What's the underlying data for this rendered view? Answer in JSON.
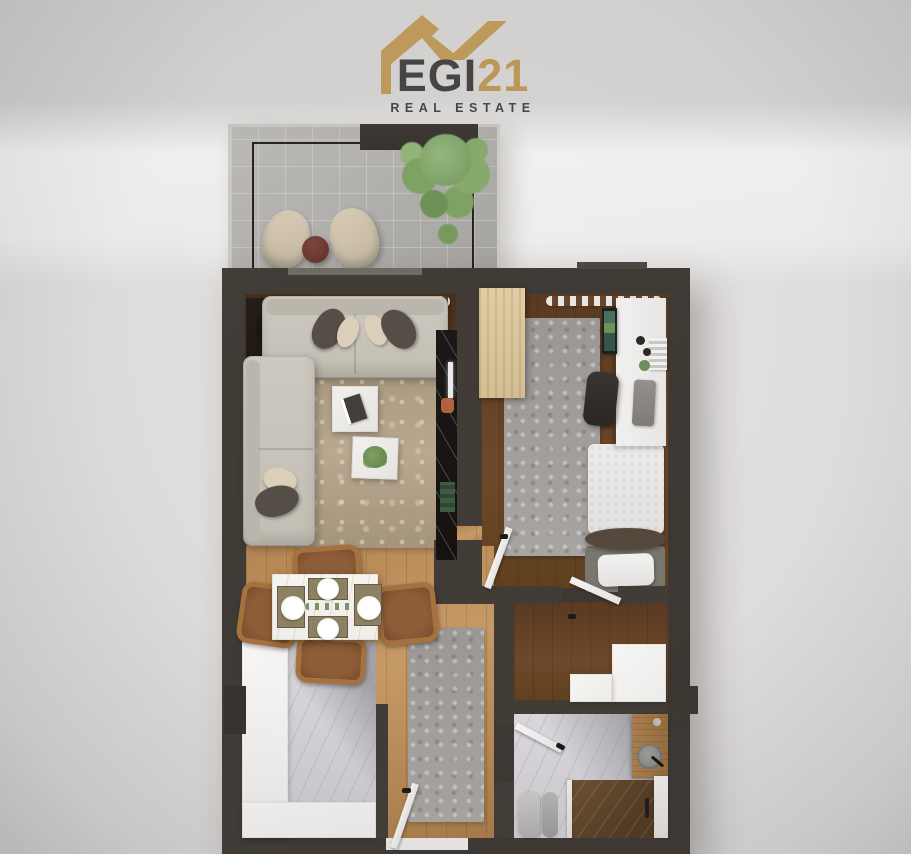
{
  "logo": {
    "brand_egi": "EGI",
    "brand_21": "21",
    "tagline": "REAL ESTATE",
    "icon": "house-roof-icon",
    "colors": {
      "gold": "#c59c52",
      "text_dark": "#3c3b3a"
    }
  },
  "palette": {
    "background": "#dedcdb",
    "wall": "#3e3934",
    "floor_living": "#6b4628",
    "floor_hall_oak": "#c59a66",
    "floor_bedroom": "#6e482a",
    "balcony_tile": "#b4b2af",
    "kitchen_counter": "#f3f2ef",
    "marble_floor": "#d6d4d8",
    "sofa": "#c9c5bb",
    "rug_living": "#b9a78f",
    "rug_gray": "#9e9b99",
    "dining_wood": "#a5713f",
    "shower_marble": "#5e4427",
    "plant_green": "#7fa368"
  },
  "floor_plan": {
    "rooms": [
      "balcony",
      "living-room",
      "bedroom",
      "hallway-dining",
      "kitchen",
      "closet",
      "bathroom"
    ],
    "furniture": [
      "outdoor-chairs",
      "outdoor-side-table",
      "balcony-plant",
      "sofa",
      "corner-sofa",
      "coffee-table",
      "plant-table",
      "console-record-player",
      "tv-marble-panel",
      "wardrobe",
      "desk",
      "office-chair",
      "bed",
      "dining-table",
      "dining-chairs",
      "kitchen-counter",
      "runner-rug",
      "closet-shelving",
      "vanity-basin",
      "toilet",
      "shower",
      "entry-door",
      "interior-doors"
    ]
  }
}
